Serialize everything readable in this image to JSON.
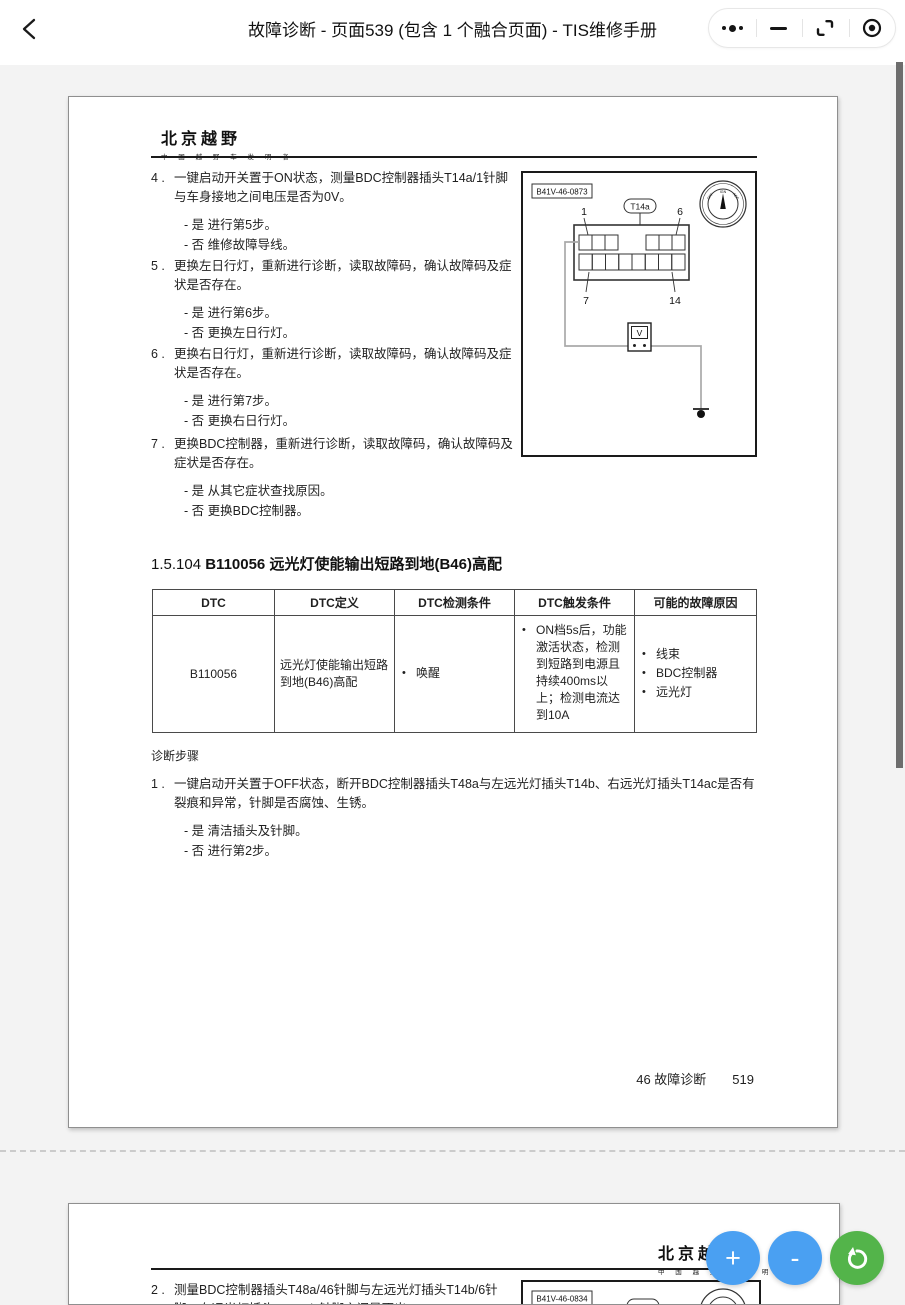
{
  "topbar": {
    "title": "故障诊断 - 页面539 (包含 1 个融合页面) - TIS维修手册",
    "back_icon": "chevron-left",
    "capsule_icons": [
      "more-options",
      "minimize",
      "restore-window",
      "record"
    ]
  },
  "page1": {
    "logo_title": "北京越野",
    "logo_subtitle": "中 国 越 野 车 发 明 者",
    "steps": [
      {
        "num": "4 .",
        "text": "一键启动开关置于ON状态，测量BDC控制器插头T14a/1针脚与车身接地之间电压是否为0V。",
        "opt_yes": "- 是 进行第5步。",
        "opt_no": "- 否 维修故障导线。"
      },
      {
        "num": "5 .",
        "text": "更换左日行灯，重新进行诊断，读取故障码，确认故障码及症状是否存在。",
        "opt_yes": "- 是 进行第6步。",
        "opt_no": "- 否 更换左日行灯。"
      },
      {
        "num": "6 .",
        "text": "更换右日行灯，重新进行诊断，读取故障码，确认故障码及症状是否存在。",
        "opt_yes": "- 是 进行第7步。",
        "opt_no": "- 否 更换右日行灯。"
      },
      {
        "num": "7 .",
        "text": "更换BDC控制器，重新进行诊断，读取故障码，确认故障码及症状是否存在。",
        "opt_yes": "- 是 从其它症状查找原因。",
        "opt_no": "- 否 更换BDC控制器。"
      }
    ],
    "diagram": {
      "ref": "B41V-46-0873",
      "connector": "T14a",
      "pin_tl": "1",
      "pin_tr": "6",
      "pin_bl": "7",
      "pin_br": "14",
      "meter": "V",
      "dial_left": "OFF",
      "dial_top": "IGN",
      "dial_right": "ACC"
    },
    "heading_prefix": "1.5.104 ",
    "heading_code": "B110056",
    "heading_rest": " 远光灯使能输出短路到地(B46)高配",
    "table": {
      "headers": [
        "DTC",
        "DTC定义",
        "DTC检测条件",
        "DTC触发条件",
        "可能的故障原因"
      ],
      "dtc": "B110056",
      "definition": "远光灯使能输出短路到地(B46)高配",
      "detect": "唤醒",
      "trigger": "ON档5s后，功能激活状态，检测到短路到电源且持续400ms以上；检测电流达到10A",
      "causes": [
        "线束",
        "BDC控制器",
        "远光灯"
      ]
    },
    "diagnosis_title": "诊断步骤",
    "step1": {
      "num": "1 .",
      "text": "一键启动开关置于OFF状态，断开BDC控制器插头T48a与左远光灯插头T14b、右远光灯插头T14ac是否有裂痕和异常，针脚是否腐蚀、生锈。",
      "opt_yes": "- 是 清洁插头及针脚。",
      "opt_no": "- 否 进行第2步。"
    },
    "footer_chapter": "46 故障诊断",
    "footer_page": "519"
  },
  "page2": {
    "logo_title": "北京越野",
    "logo_subtitle": "中 国 越 野 车 发 明 者",
    "step2_num": "2 .",
    "step2_text": "测量BDC控制器插头T48a/46针脚与左远光灯插头T14b/6针脚、右远光灯插头T14ac/6针脚之间是否出",
    "diagram_ref": "B41V-46-0834"
  },
  "fab": {
    "zoom_in": "+",
    "zoom_out": "-",
    "rotate_icon": "rotate-ccw"
  },
  "colors": {
    "fab_blue": "#4aa0f2",
    "fab_green": "#53b44a",
    "background": "#f3f3f3",
    "scrollbar": "#6d6d6d"
  }
}
